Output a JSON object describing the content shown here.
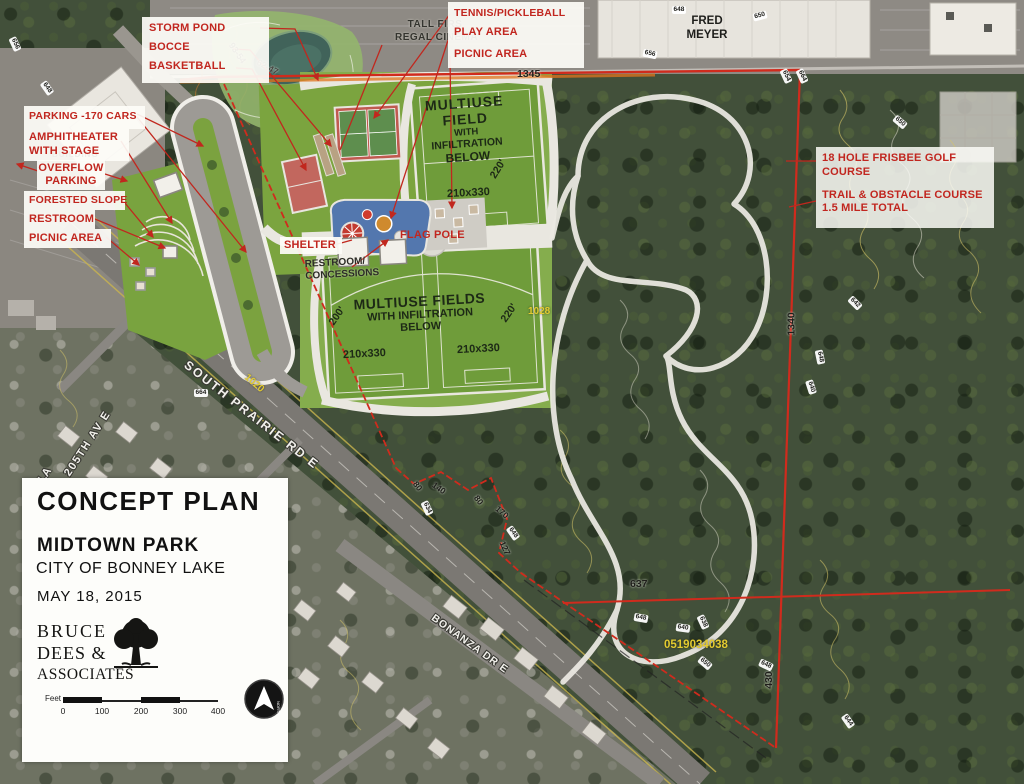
{
  "callouts": {
    "storm_pond": "STORM POND",
    "bocce": "BOCCE",
    "basketball": "BASKETBALL",
    "tennis_pickleball": "TENNIS/PICKLEBALL",
    "play_area": "PLAY AREA",
    "picnic_area_top": "PICNIC AREA",
    "parking_170": "PARKING -170 CARS",
    "amphitheater_line1": "AMPHITHEATER",
    "amphitheater_line2": "WITH STAGE",
    "overflow_line1": "OVERFLOW",
    "overflow_line2": "PARKING",
    "forested_slope": "FORESTED SLOPE",
    "restroom": "RESTROOM",
    "picnic_area_left": "PICNIC AREA",
    "shelter": "SHELTER",
    "flag_pole": "FLAG POLE",
    "frisbee_line1": "18 HOLE FRISBEE GOLF",
    "frisbee_line2": "COURSE",
    "trail_line1": "TRAIL & OBSTACLE COURSE",
    "trail_line2": "1.5 MILE TOTAL"
  },
  "map_labels": {
    "tall_firs_line1": "TALL FIRS",
    "tall_firs_line2": "REGAL CINEMA",
    "fred_meyer_line1": "FRED",
    "fred_meyer_line2": "MEYER",
    "building": "BUILDING",
    "restroom_conc_line1": "RESTROOM/",
    "restroom_conc_line2": "CONCESSIONS",
    "field_top_l1": "MULTIUSE",
    "field_top_l2": "FIELD",
    "field_top_l3": "WITH",
    "field_top_l4": "INFILTRATION",
    "field_top_l5": "BELOW",
    "fields_bottom_l1": "MULTIUSE FIELDS",
    "fields_bottom_l2": "WITH INFILTRATION",
    "fields_bottom_l3": "BELOW",
    "dim_220_top": "220'",
    "dim_200": "200'",
    "dim_220_bottom": "220'",
    "size_field_top": "210x330",
    "size_field_left": "210x330",
    "size_field_right": "210x330"
  },
  "streets": {
    "south_prairie": "SOUTH PRAIRIE RD E",
    "ave_205": "205TH AV E",
    "bonanza": "BONANZA DR E",
    "partial_la": "LA"
  },
  "boundary_dims": {
    "top": "1345",
    "right": "1340",
    "middle": "637",
    "lower_right": "430",
    "seg1": "80",
    "seg2": "140",
    "seg3": "80",
    "seg4": "170",
    "seg5": "127",
    "survey1": "93-54",
    "survey2": "62-47"
  },
  "parcel": {
    "number": "0519034038",
    "road_grade_1": "1020",
    "road_grade_2": "1028"
  },
  "contours": [
    "648",
    "650",
    "656",
    "654",
    "664",
    "642",
    "648",
    "640",
    "648",
    "640",
    "638",
    "650",
    "648",
    "644",
    "634",
    "648",
    "664",
    "656",
    "648",
    "650"
  ],
  "title_block": {
    "title": "CONCEPT PLAN",
    "park": "MIDTOWN PARK",
    "city": "CITY OF BONNEY LAKE",
    "date": "MAY 18, 2015",
    "firm1": "BRUCE",
    "firm2": "DEES &",
    "firm3": "ASSOCIATES",
    "feet_label": "Feet",
    "ticks": [
      "0",
      "100",
      "200",
      "300",
      "400"
    ],
    "north": "NORTH"
  }
}
